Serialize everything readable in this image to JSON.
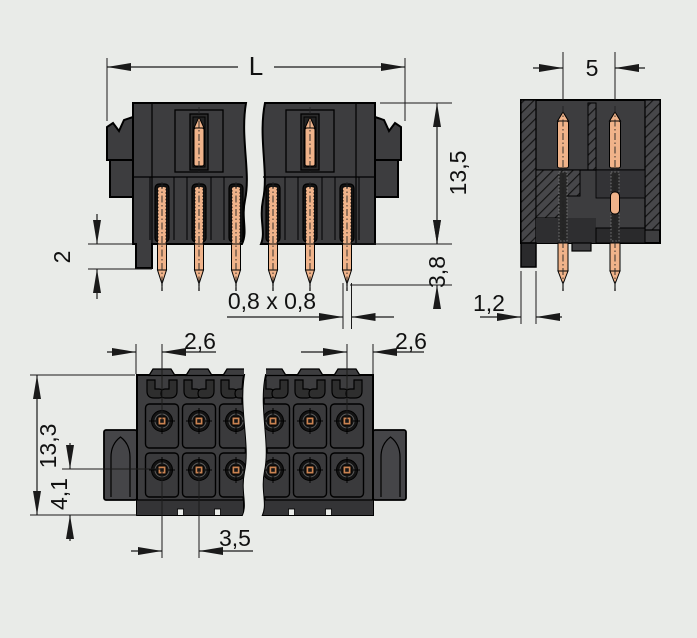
{
  "drawing": {
    "kind": "connector-technical-drawing",
    "views": {
      "front": "front-elevation-with-break-lines",
      "side": "side-section",
      "bottom": "mating-face"
    }
  },
  "dims": {
    "front": {
      "length": "L",
      "height": "13,5",
      "protrusion": "3,8",
      "step": "2",
      "pin_square": "0,8 x 0,8"
    },
    "side": {
      "pitch": "5",
      "leg": "1,2"
    },
    "bottom": {
      "left_margin": "2,6",
      "right_margin": "2,6",
      "depth": "13,3",
      "offset": "4,1",
      "pitch": "3,5"
    }
  },
  "colors": {
    "background": "#e9ebe8",
    "housing": "#3d3d3f",
    "channel": "#131313",
    "pin_copper": "#f0b38a",
    "pin_copper_dark": "#ca8352",
    "line": "#1a1a1a"
  }
}
